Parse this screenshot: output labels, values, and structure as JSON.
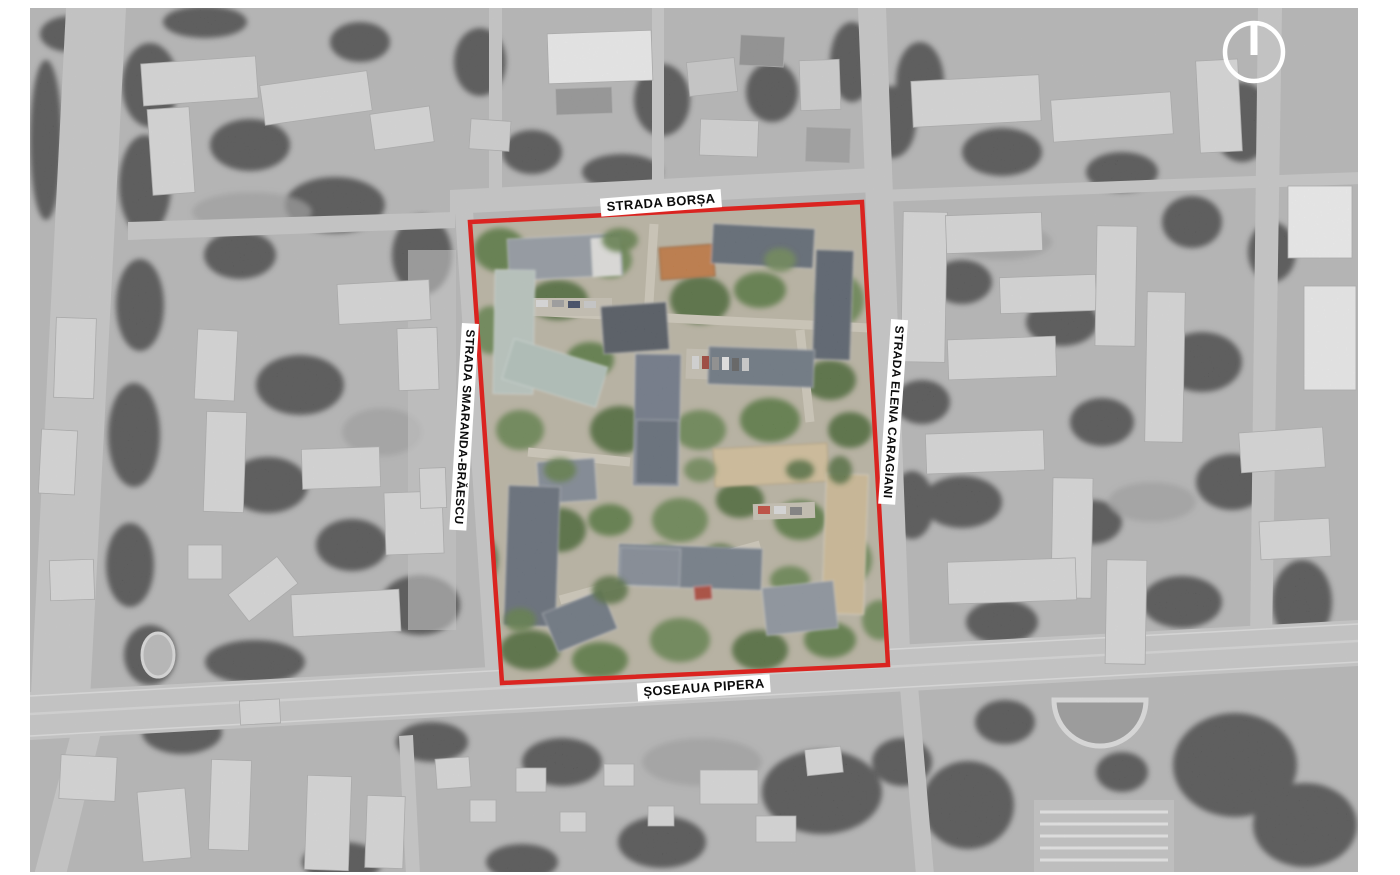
{
  "map": {
    "street_labels": {
      "top": "STRADA BORȘA",
      "left": "STRADA SMARANDA-BRĂESCU",
      "right": "STRADA ELENA CARAGIANI",
      "bottom": "ȘOSEAUA PIPERA"
    },
    "site_outline_color": "#da2420",
    "icons": {
      "north_arrow": "circle-with-north-bar"
    }
  }
}
